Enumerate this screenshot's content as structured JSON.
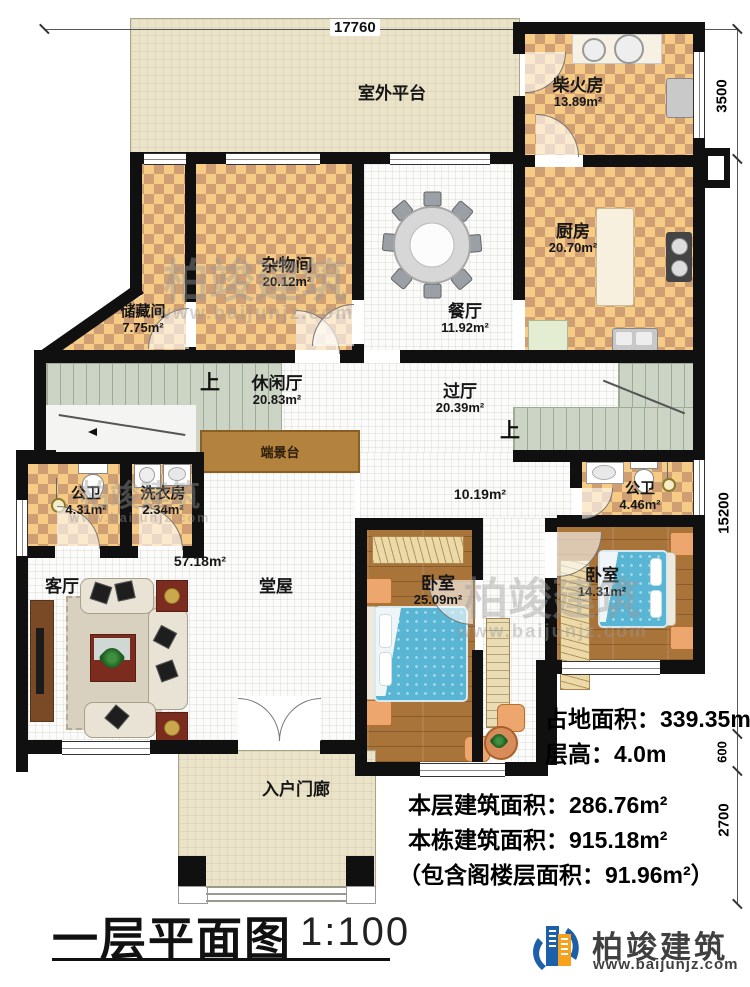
{
  "meta": {
    "title": "一层平面图",
    "scale": "1:100"
  },
  "dims": {
    "top": "17760",
    "right_upper": "3500",
    "right_main": "15200",
    "right_small": "600",
    "right_bottom": "2700"
  },
  "rooms": {
    "platform": {
      "name": "室外平台"
    },
    "firewood": {
      "name": "柴火房",
      "area": "13.89m²"
    },
    "kitchen": {
      "name": "厨房",
      "area": "20.70m²"
    },
    "sundry": {
      "name": "杂物间",
      "area": "20.12m²"
    },
    "storage": {
      "name": "储藏间",
      "area": "7.75m²"
    },
    "dining": {
      "name": "餐厅",
      "area": "11.92m²"
    },
    "leisure": {
      "name": "休闲厅",
      "area": "20.83m²"
    },
    "hallway": {
      "name": "过厅",
      "area": "20.39m²"
    },
    "corridor": {
      "area": "10.19m²"
    },
    "bath_left": {
      "name": "公卫",
      "area": "4.31m²"
    },
    "laundry": {
      "name": "洗衣房",
      "area": "2.34m²"
    },
    "console": {
      "name": "端景台"
    },
    "bath_right": {
      "name": "公卫",
      "area": "4.46m²"
    },
    "living": {
      "name": "客厅"
    },
    "hall": {
      "name": "堂屋",
      "area": "57.18m²"
    },
    "bedroom_left": {
      "name": "卧室",
      "area": "25.09m²"
    },
    "bedroom_right": {
      "name": "卧室",
      "area": "14.31m²"
    },
    "porch": {
      "name": "入户门廊"
    }
  },
  "stairs": {
    "up": "上"
  },
  "stats": {
    "land": "占地面积：339.35m²",
    "floor_height": "层高：4.0m",
    "this_floor": "本层建筑面积：286.76m²",
    "building_total": "本栋建筑面积：915.18m²",
    "attic_note": "（包含阁楼层面积：91.96m²）"
  },
  "brand": {
    "name": "柏竣建筑",
    "site": "www.baijunjz.com"
  },
  "watermark": {
    "name": "柏竣建筑",
    "site": "www.baijunjz.com"
  }
}
